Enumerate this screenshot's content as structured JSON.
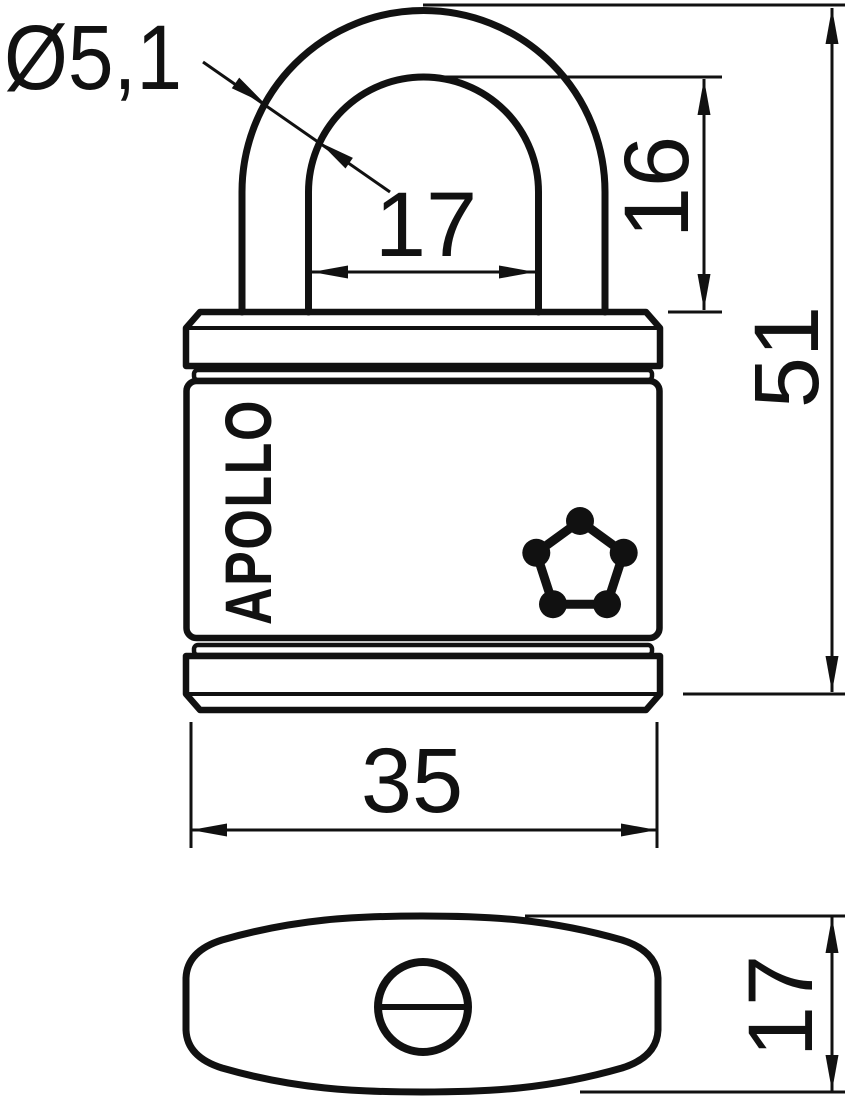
{
  "page": {
    "background": "#ffffff",
    "line_color": "#111111"
  },
  "drawing": {
    "brand": "APOLLO",
    "dimensions": {
      "shackle_diameter": "Ø5,1",
      "shackle_inner_width": "17",
      "shackle_clearance_height": "16",
      "overall_height": "51",
      "body_width": "35",
      "body_depth": "17"
    },
    "icons": {
      "pentagon_logo": "pentagon-with-five-dots",
      "keyhole": "circle-with-horizontal-slot"
    }
  }
}
